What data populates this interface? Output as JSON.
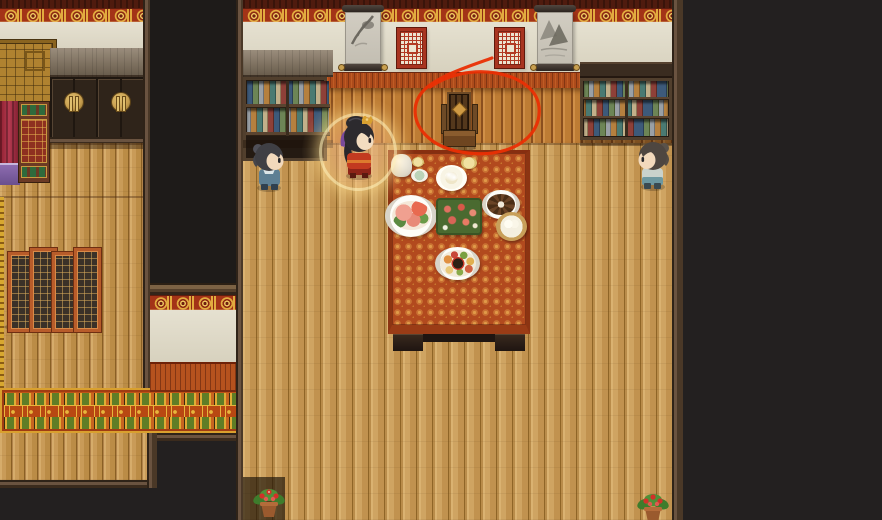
{
  "app": {
    "name": "top-down RPG interior scene",
    "style": "pixel-art Chinese house interior with dining banquet",
    "visible_text": ""
  },
  "palette": {
    "void": "#232020",
    "wall-cream": "#e0dac6",
    "frieze-red": "#a33317",
    "frieze-gold": "#e2ab3f",
    "wainscot": "#bf8038",
    "floor": "#cda15e",
    "tablecloth": "#b24a1e",
    "carpet": "#c05417",
    "window-red": "#b23a24",
    "annotation-red": "#ea2f04",
    "glow": "#ffe196"
  },
  "scene": {
    "annotation": {
      "type": "hand-drawn-ellipse",
      "color": "#ea2f04",
      "target": "high-back wooden chair at head of the table"
    },
    "objects": [
      {
        "label": "canopy bed with red curtain"
      },
      {
        "label": "double cabinet with moon handles"
      },
      {
        "label": "folding lattice screen"
      },
      {
        "label": "ornamental carpet runner"
      },
      {
        "label": "dark doorway opening"
      },
      {
        "label": "left bookshelf"
      },
      {
        "label": "right bookshelf"
      },
      {
        "label": "ink scroll painting left"
      },
      {
        "label": "ink scroll painting right"
      },
      {
        "label": "red lattice window left"
      },
      {
        "label": "red lattice window right"
      },
      {
        "label": "high-back wooden chair (circled)"
      },
      {
        "label": "banquet table with red cloth"
      },
      {
        "label": "flower pot left"
      },
      {
        "label": "flower pot right"
      }
    ],
    "characters": [
      {
        "id": "npc-left",
        "appearance": "gray-haired attendant in teal robe",
        "facing": "right"
      },
      {
        "id": "player",
        "appearance": "black-haired girl in red dress with gold hairpiece and glowing aura",
        "facing": "right"
      },
      {
        "id": "npc-right",
        "appearance": "gray-haired attendant in pale robe",
        "facing": "left"
      }
    ],
    "dishes": [
      {
        "label": "white teapot"
      },
      {
        "label": "small yellow cup"
      },
      {
        "label": "celadon teacup"
      },
      {
        "label": "soup bowl with dumplings"
      },
      {
        "label": "small yellow side dish"
      },
      {
        "label": "shrimp platter"
      },
      {
        "label": "diced meat platter with greens"
      },
      {
        "label": "roast slices plate"
      },
      {
        "label": "bamboo steamer with buns"
      },
      {
        "label": "banquet sampler platter with dip"
      }
    ]
  }
}
